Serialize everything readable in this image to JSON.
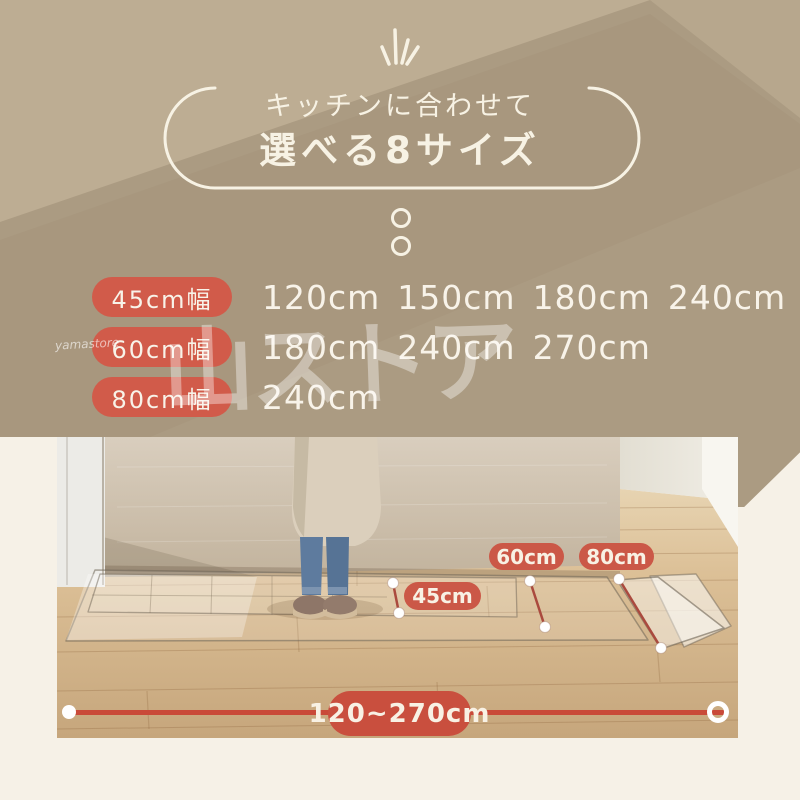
{
  "header": {
    "line1": "キッチンに合わせて",
    "line2": "選べる8サイズ"
  },
  "size_table": {
    "rows": [
      {
        "width_label": "45cm幅",
        "lengths": [
          "120cm",
          "150cm",
          "180cm",
          "240cm"
        ]
      },
      {
        "width_label": "60cm幅",
        "lengths": [
          "180cm",
          "240cm",
          "270cm"
        ]
      },
      {
        "width_label": "80cm幅",
        "lengths": [
          "240cm"
        ]
      }
    ]
  },
  "watermark": {
    "main": "山ストア",
    "small": "yamastore"
  },
  "photo": {
    "labels": {
      "w45": "45cm",
      "w60": "60cm",
      "w80": "80cm"
    },
    "length_range": "120~270cm"
  },
  "colors": {
    "tan_base": "#ab9b82",
    "tan_light": "#bdad93",
    "tan_dark": "#a3937b",
    "cream": "#f6f1e7",
    "pill_red": "#d15b4a",
    "photo_pill_red": "#cb5847",
    "line_red": "#c94a39",
    "measure_red": "#aa4a3e",
    "text_cream": "#f8f3e9"
  }
}
